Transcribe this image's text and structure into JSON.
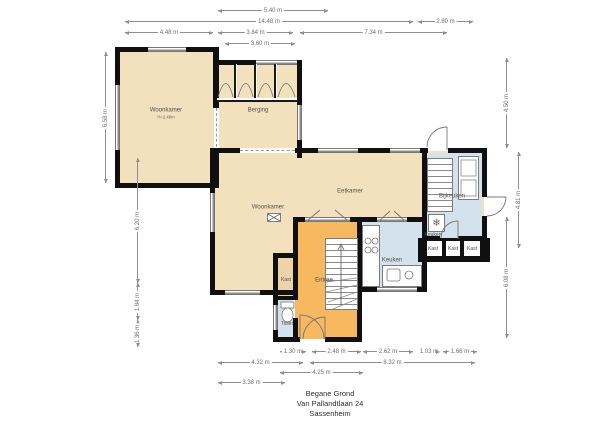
{
  "title": {
    "line1": "Begane Grond",
    "line2": "Van Pallandtlaan 24",
    "line3": "Sassenheim"
  },
  "rooms": {
    "woonkamer_left": {
      "name": "Woonkamer",
      "sub": "H=2.48m"
    },
    "berging": {
      "name": "Berging"
    },
    "woonkamer": {
      "name": "Woonkamer"
    },
    "eetkamer": {
      "name": "Eetkamer"
    },
    "bijkeuken": {
      "name": "Bijkeuken"
    },
    "keuken": {
      "name": "Keuken"
    },
    "keuken_klein": {
      "name": "Keuken"
    },
    "entree": {
      "name": "Entree"
    },
    "kast": {
      "name": "Kast"
    },
    "toilet": {
      "name": "Toilet"
    },
    "kast_1": {
      "name": "Kast"
    },
    "kast_2": {
      "name": "Kast"
    },
    "kast_3": {
      "name": "Kast"
    }
  },
  "dimensions": {
    "top": [
      {
        "label": "5.40 m"
      },
      {
        "label": "14.48 m"
      },
      {
        "label": "2.80 m"
      },
      {
        "label": "4.48 m"
      },
      {
        "label": "3.84 m"
      },
      {
        "label": "7.34 m"
      },
      {
        "label": "3.60 m"
      }
    ],
    "left": [
      {
        "label": "6.58 m"
      },
      {
        "label": "6.20 m"
      },
      {
        "label": "1.84 m"
      },
      {
        "label": "1.36 m"
      }
    ],
    "right": [
      {
        "label": "4.50 m"
      },
      {
        "label": "4.81 m"
      },
      {
        "label": "6.08 m"
      }
    ],
    "bottom": [
      {
        "label": "1.30 m"
      },
      {
        "label": "2.48 m"
      },
      {
        "label": "2.62 m"
      },
      {
        "label": "1.03 m"
      },
      {
        "label": "1.66 m"
      },
      {
        "label": "4.32 m"
      },
      {
        "label": "8.32 m"
      },
      {
        "label": "4.25 m"
      },
      {
        "label": "3.38 m"
      }
    ]
  },
  "colors": {
    "room_beige": "#f3e0bd",
    "room_tan": "#ecd4a8",
    "room_orange": "#f8b860",
    "room_blue": "#d3e2ec",
    "wall": "#101010",
    "dimension_line": "#8f8f8f"
  }
}
